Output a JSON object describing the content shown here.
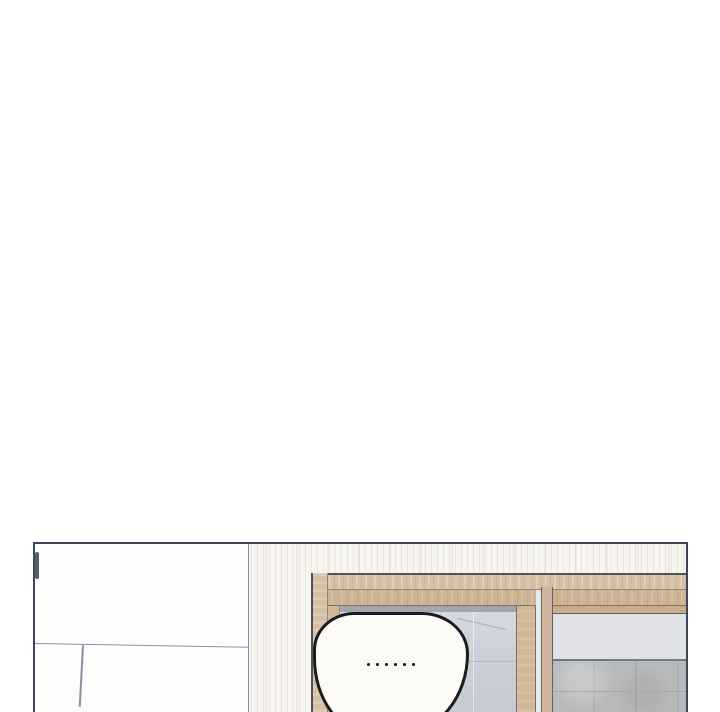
{
  "page": {
    "background": "#ffffff"
  },
  "panel": {
    "bubble": {
      "text": "......",
      "dot_count": 6
    },
    "colors": {
      "panel-border": "#3b4656",
      "line-thin": "#8792a0",
      "frame-dark": "#4d525b",
      "wall": "#f7f5ef",
      "cabinet": "#fdfdfd",
      "wood-light": "#d6c0a5",
      "wood-mid": "#cdb293",
      "wood-stile": "#d3b796",
      "wood-pink": "#d0b4a0",
      "glass": "#cbcfd8",
      "glass-top": "#d6d9e0",
      "frosted-top": "#e0e2e6",
      "frosted-bottom": "#b7b9bb",
      "bubble-fill": "#fcfbf8",
      "bubble-border": "#1b1b1b",
      "handle": "#59606a"
    }
  }
}
